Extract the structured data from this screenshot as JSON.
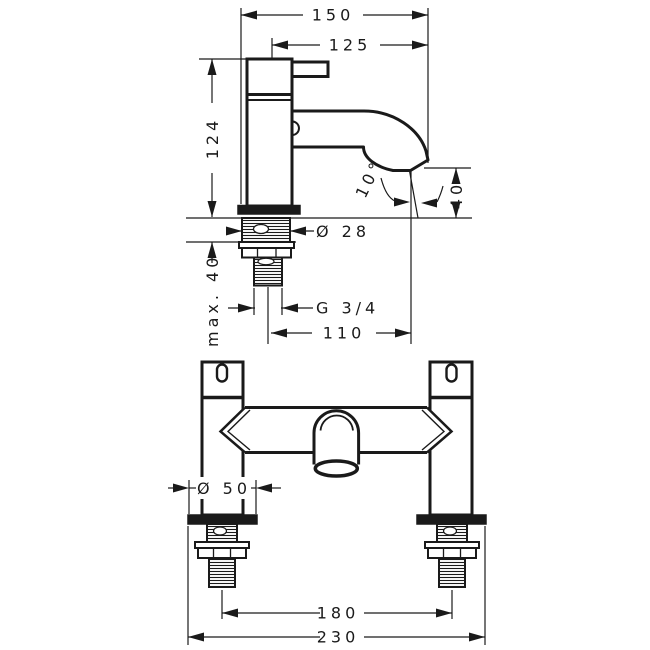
{
  "drawing": {
    "type": "faucet technical dimension drawing",
    "background": "#ffffff",
    "line_color": "#1a1a1a",
    "side_view": {
      "name": "pillar tap side elevation",
      "dimensions": {
        "total_projection": "150",
        "spout_projection": "125",
        "body_height": "124",
        "spout_angle": "10°",
        "spout_clearance": "40",
        "shank_diameter": "Ø 28",
        "max_mounting_depth": "max. 40",
        "connection_thread": "G 3/4",
        "spout_reach": "110"
      }
    },
    "front_view": {
      "name": "bath mixer front elevation",
      "dimensions": {
        "base_diameter": "Ø 50",
        "inlet_center_distance": "180",
        "overall_width": "230"
      }
    }
  }
}
